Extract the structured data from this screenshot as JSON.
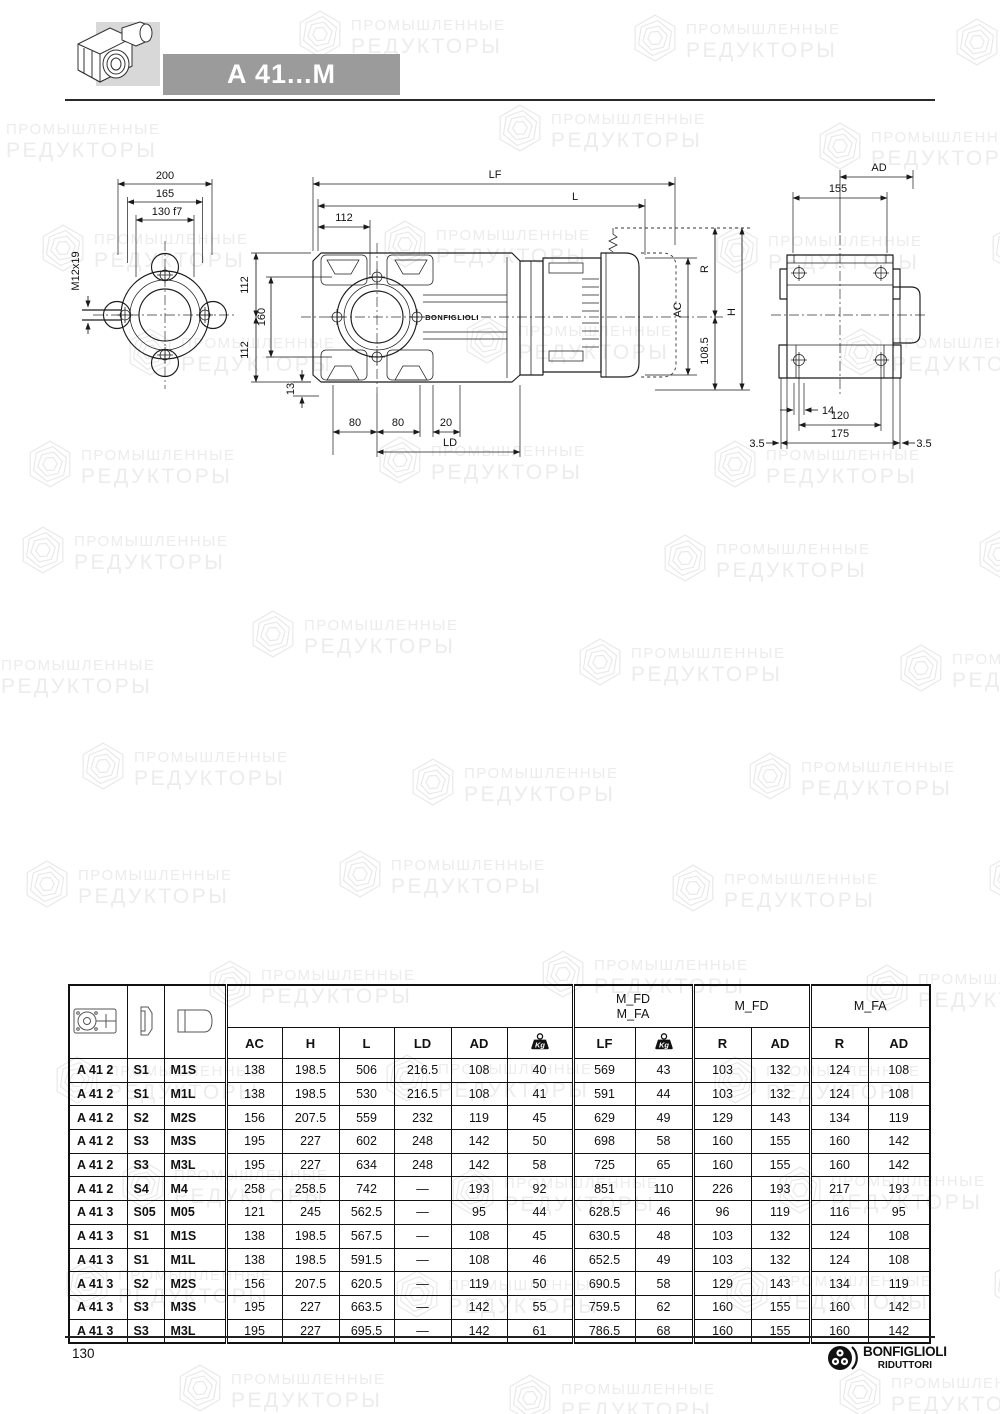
{
  "header": {
    "title": "A 41...M",
    "banner_color": "#9b9b9b"
  },
  "watermark": {
    "line1": "ПРОМЫШЛЕННЫЕ",
    "line2": "РЕДУКТОРЫ",
    "color": "#ececec",
    "icon": "hexagon-swirl-icon",
    "positions": [
      [
        295,
        8
      ],
      [
        630,
        12
      ],
      [
        952,
        16
      ],
      [
        -50,
        112
      ],
      [
        495,
        102
      ],
      [
        815,
        120
      ],
      [
        38,
        222
      ],
      [
        380,
        218
      ],
      [
        712,
        224
      ],
      [
        988,
        222
      ],
      [
        125,
        326
      ],
      [
        462,
        314
      ],
      [
        836,
        326
      ],
      [
        25,
        438
      ],
      [
        375,
        434
      ],
      [
        710,
        438
      ],
      [
        18,
        524
      ],
      [
        660,
        532
      ],
      [
        975,
        528
      ],
      [
        -55,
        648
      ],
      [
        248,
        608
      ],
      [
        575,
        636
      ],
      [
        896,
        642
      ],
      [
        78,
        740
      ],
      [
        408,
        756
      ],
      [
        745,
        750
      ],
      [
        22,
        858
      ],
      [
        335,
        848
      ],
      [
        668,
        862
      ],
      [
        985,
        852
      ],
      [
        205,
        958
      ],
      [
        538,
        948
      ],
      [
        862,
        962
      ],
      [
        52,
        1054
      ],
      [
        382,
        1052
      ],
      [
        710,
        1054
      ],
      [
        118,
        1158
      ],
      [
        448,
        1166
      ],
      [
        775,
        1164
      ],
      [
        62,
        1258
      ],
      [
        392,
        1268
      ],
      [
        722,
        1264
      ],
      [
        990,
        1258
      ],
      [
        175,
        1362
      ],
      [
        505,
        1372
      ],
      [
        835,
        1366
      ]
    ]
  },
  "drawing": {
    "front": {
      "d200": "200",
      "d165": "165",
      "d130": "130 f7",
      "m12": "M12x19"
    },
    "side": {
      "LF": "LF",
      "L": "L",
      "d112_top": "112",
      "d112_left_a": "112",
      "d160": "160",
      "d112_left_b": "112",
      "d13": "13",
      "d80a": "80",
      "d80b": "80",
      "d20": "20",
      "LD": "LD",
      "AC": "AC",
      "R": "R",
      "d108": "108.5",
      "H": "H",
      "brand": "BONFIGLIOLI"
    },
    "rear": {
      "AD": "AD",
      "d155": "155",
      "d14": "14",
      "d120": "120",
      "d175": "175",
      "d35l": "3.5",
      "d35r": "3.5"
    }
  },
  "table": {
    "icons": [
      "gearbox-top-view-icon",
      "flange-icon",
      "motor-icon"
    ],
    "kg_icon_label": "Kg",
    "groups": {
      "g1_line1": "M_FD",
      "g1_line2": "M_FA",
      "g2": "M_FD",
      "g3": "M_FA"
    },
    "columns": {
      "ac": "AC",
      "h": "H",
      "l": "L",
      "ld": "LD",
      "ad": "AD",
      "lf": "LF",
      "r": "R",
      "ad2": "AD",
      "r2": "R",
      "ad3": "AD"
    },
    "rows": [
      {
        "model": "A 41 2",
        "s": "S1",
        "m": "M1S",
        "values": [
          "138",
          "198.5",
          "506",
          "216.5",
          "108",
          "40",
          "569",
          "43",
          "103",
          "132",
          "124",
          "108"
        ]
      },
      {
        "model": "A 41 2",
        "s": "S1",
        "m": "M1L",
        "values": [
          "138",
          "198.5",
          "530",
          "216.5",
          "108",
          "41",
          "591",
          "44",
          "103",
          "132",
          "124",
          "108"
        ]
      },
      {
        "model": "A 41 2",
        "s": "S2",
        "m": "M2S",
        "values": [
          "156",
          "207.5",
          "559",
          "232",
          "119",
          "45",
          "629",
          "49",
          "129",
          "143",
          "134",
          "119"
        ]
      },
      {
        "model": "A 41 2",
        "s": "S3",
        "m": "M3S",
        "values": [
          "195",
          "227",
          "602",
          "248",
          "142",
          "50",
          "698",
          "58",
          "160",
          "155",
          "160",
          "142"
        ]
      },
      {
        "model": "A 41 2",
        "s": "S3",
        "m": "M3L",
        "values": [
          "195",
          "227",
          "634",
          "248",
          "142",
          "58",
          "725",
          "65",
          "160",
          "155",
          "160",
          "142"
        ]
      },
      {
        "model": "A 41 2",
        "s": "S4",
        "m": "M4",
        "values": [
          "258",
          "258.5",
          "742",
          "—",
          "193",
          "92",
          "851",
          "110",
          "226",
          "193",
          "217",
          "193"
        ]
      },
      {
        "model": "A 41 3",
        "s": "S05",
        "m": "M05",
        "values": [
          "121",
          "245",
          "562.5",
          "—",
          "95",
          "44",
          "628.5",
          "46",
          "96",
          "119",
          "116",
          "95"
        ]
      },
      {
        "model": "A 41 3",
        "s": "S1",
        "m": "M1S",
        "values": [
          "138",
          "198.5",
          "567.5",
          "—",
          "108",
          "45",
          "630.5",
          "48",
          "103",
          "132",
          "124",
          "108"
        ]
      },
      {
        "model": "A 41 3",
        "s": "S1",
        "m": "M1L",
        "values": [
          "138",
          "198.5",
          "591.5",
          "—",
          "108",
          "46",
          "652.5",
          "49",
          "103",
          "132",
          "124",
          "108"
        ]
      },
      {
        "model": "A 41 3",
        "s": "S2",
        "m": "M2S",
        "values": [
          "156",
          "207.5",
          "620.5",
          "—",
          "119",
          "50",
          "690.5",
          "58",
          "129",
          "143",
          "134",
          "119"
        ]
      },
      {
        "model": "A 41 3",
        "s": "S3",
        "m": "M3S",
        "values": [
          "195",
          "227",
          "663.5",
          "—",
          "142",
          "55",
          "759.5",
          "62",
          "160",
          "155",
          "160",
          "142"
        ]
      },
      {
        "model": "A 41 3",
        "s": "S3",
        "m": "M3L",
        "values": [
          "195",
          "227",
          "695.5",
          "—",
          "142",
          "61",
          "786.5",
          "68",
          "160",
          "155",
          "160",
          "142"
        ]
      }
    ]
  },
  "footer": {
    "page_number": "130",
    "logo_line1": "BONFIGLIOLI",
    "logo_line2": "RIDUTTORI"
  }
}
